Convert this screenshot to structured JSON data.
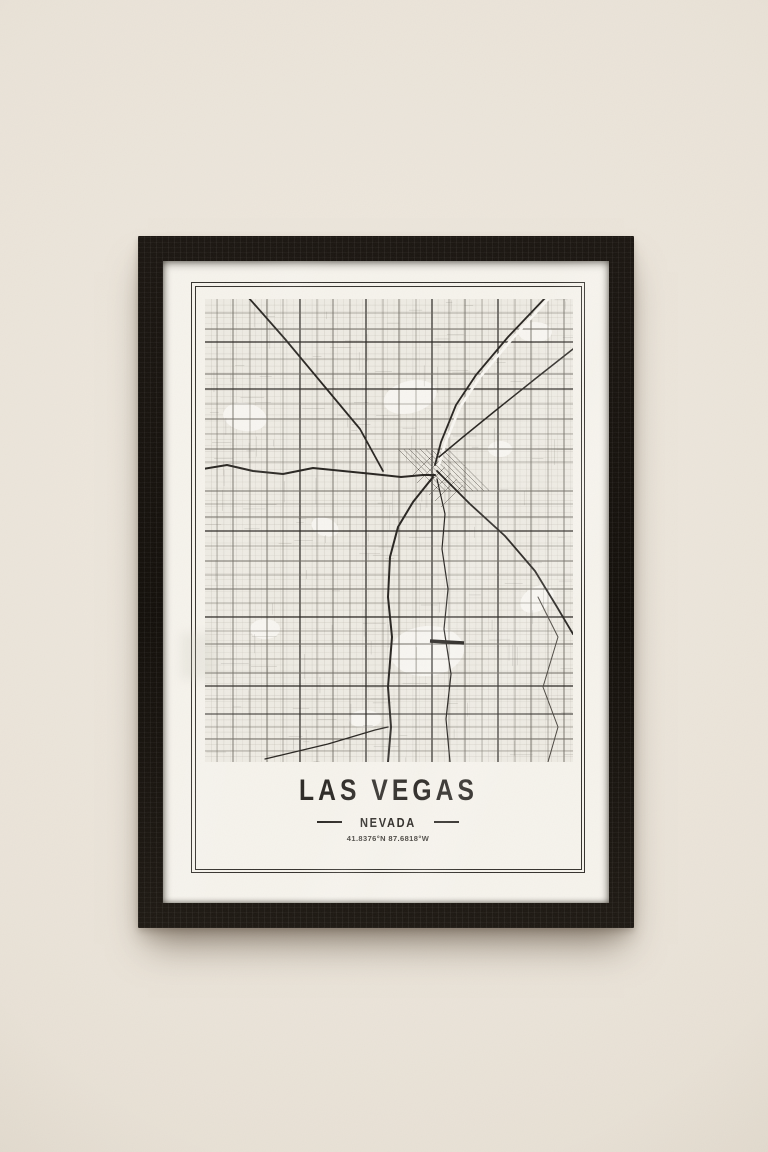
{
  "poster": {
    "title": "LAS VEGAS",
    "subtitle": "NEVADA",
    "coordinates": "41.8376°N 87.6818°W"
  },
  "palette": {
    "wall": "#eae3d8",
    "frame": "#17130e",
    "mat": "#f6f3ec",
    "paper": "#f0ede5",
    "ink": "#2b2824"
  },
  "map": {
    "width": 368,
    "height": 463,
    "bg": "#f0ede5",
    "road_dark": "#26231f",
    "road_mid": "#6e6a61",
    "patch_color": "#fbf9f4",
    "fine_grid": {
      "spacing_x": 6.3,
      "spacing_y": 6.1,
      "color": "#b7b3a9",
      "width": 0.35
    },
    "minor_streets": {
      "count": 170,
      "color": "#8f8b82",
      "width": 0.45,
      "opacity": 0.5,
      "seed": 7
    },
    "patches": [
      {
        "cx": 205,
        "cy": 98,
        "rx": 27,
        "ry": 16,
        "rot": -15
      },
      {
        "cx": 40,
        "cy": 118,
        "rx": 22,
        "ry": 14,
        "rot": 10
      },
      {
        "cx": 222,
        "cy": 352,
        "rx": 37,
        "ry": 25,
        "rot": -5
      },
      {
        "cx": 330,
        "cy": 33,
        "rx": 17,
        "ry": 10,
        "rot": 0
      },
      {
        "cx": 120,
        "cy": 228,
        "rx": 14,
        "ry": 9,
        "rot": 20
      },
      {
        "cx": 332,
        "cy": 300,
        "rx": 18,
        "ry": 12,
        "rot": -30
      },
      {
        "cx": 60,
        "cy": 330,
        "rx": 15,
        "ry": 10,
        "rot": 0
      },
      {
        "cx": 295,
        "cy": 150,
        "rx": 12,
        "ry": 8,
        "rot": 0
      },
      {
        "cx": 160,
        "cy": 420,
        "rx": 16,
        "ry": 9,
        "rot": 0
      }
    ],
    "verticals": [
      {
        "x": 12,
        "w": 0.5
      },
      {
        "x": 28,
        "w": 0.9
      },
      {
        "x": 45,
        "w": 0.5
      },
      {
        "x": 62,
        "w": 0.9
      },
      {
        "x": 78,
        "w": 0.5
      },
      {
        "x": 95,
        "w": 1.2
      },
      {
        "x": 112,
        "w": 0.5
      },
      {
        "x": 128,
        "w": 0.9
      },
      {
        "x": 145,
        "w": 0.5
      },
      {
        "x": 161,
        "w": 1.2
      },
      {
        "x": 178,
        "w": 0.5
      },
      {
        "x": 194,
        "w": 0.9
      },
      {
        "x": 211,
        "w": 0.5
      },
      {
        "x": 227,
        "w": 1.2
      },
      {
        "x": 244,
        "w": 0.5
      },
      {
        "x": 260,
        "w": 0.9
      },
      {
        "x": 277,
        "w": 0.5
      },
      {
        "x": 293,
        "w": 1.2
      },
      {
        "x": 310,
        "w": 0.5
      },
      {
        "x": 326,
        "w": 0.9
      },
      {
        "x": 343,
        "w": 0.5
      },
      {
        "x": 359,
        "w": 0.9
      }
    ],
    "horizontals": [
      {
        "y": 14,
        "w": 0.5
      },
      {
        "y": 30,
        "w": 0.9
      },
      {
        "y": 43,
        "w": 1.2
      },
      {
        "y": 60,
        "w": 0.5
      },
      {
        "y": 75,
        "w": 0.9
      },
      {
        "y": 90,
        "w": 1.2
      },
      {
        "y": 105,
        "w": 0.5
      },
      {
        "y": 120,
        "w": 0.9
      },
      {
        "y": 135,
        "w": 0.5
      },
      {
        "y": 150,
        "w": 0.9
      },
      {
        "y": 163,
        "w": 0.5
      },
      {
        "y": 192,
        "w": 0.9
      },
      {
        "y": 205,
        "w": 0.5
      },
      {
        "y": 218,
        "w": 0.9
      },
      {
        "y": 232,
        "w": 1.2
      },
      {
        "y": 247,
        "w": 0.5
      },
      {
        "y": 262,
        "w": 0.9
      },
      {
        "y": 276,
        "w": 0.5
      },
      {
        "y": 290,
        "w": 0.9
      },
      {
        "y": 304,
        "w": 0.5
      },
      {
        "y": 318,
        "w": 1.3
      },
      {
        "y": 332,
        "w": 0.5
      },
      {
        "y": 345,
        "w": 0.9
      },
      {
        "y": 360,
        "w": 0.5
      },
      {
        "y": 374,
        "w": 0.9
      },
      {
        "y": 387,
        "w": 1.3
      },
      {
        "y": 400,
        "w": 0.5
      },
      {
        "y": 415,
        "w": 1.1
      },
      {
        "y": 428,
        "w": 0.5
      },
      {
        "y": 440,
        "w": 0.9
      },
      {
        "y": 452,
        "w": 0.5
      }
    ],
    "highways": [
      {
        "name": "wash-halo",
        "color": "#fbf9f4",
        "w": 2.6,
        "points": [
          [
            345,
            -2
          ],
          [
            307,
            40
          ],
          [
            275,
            78
          ],
          [
            255,
            108
          ],
          [
            240,
            145
          ],
          [
            234,
            166
          ]
        ]
      },
      {
        "name": "rancho-dr",
        "w": 1.8,
        "points": [
          [
            43,
            -2
          ],
          [
            80,
            40
          ],
          [
            120,
            88
          ],
          [
            155,
            130
          ],
          [
            178,
            172
          ]
        ]
      },
      {
        "name": "us95-west",
        "w": 2.0,
        "points": [
          [
            -2,
            170
          ],
          [
            22,
            166
          ],
          [
            48,
            172
          ],
          [
            78,
            175
          ],
          [
            108,
            169
          ],
          [
            138,
            172
          ],
          [
            168,
            175
          ],
          [
            196,
            178
          ],
          [
            218,
            176
          ],
          [
            230,
            176
          ]
        ]
      },
      {
        "name": "i515-north",
        "w": 1.8,
        "points": [
          [
            341,
            -2
          ],
          [
            303,
            38
          ],
          [
            271,
            76
          ],
          [
            251,
            106
          ],
          [
            236,
            143
          ],
          [
            230,
            166
          ]
        ]
      },
      {
        "name": "east-diagonal",
        "w": 1.5,
        "points": [
          [
            368,
            50
          ],
          [
            330,
            80
          ],
          [
            290,
            112
          ],
          [
            258,
            138
          ],
          [
            234,
            158
          ]
        ]
      },
      {
        "name": "boulder-hwy",
        "w": 1.8,
        "points": [
          [
            232,
            172
          ],
          [
            265,
            205
          ],
          [
            300,
            237
          ],
          [
            330,
            272
          ],
          [
            352,
            308
          ],
          [
            368,
            335
          ]
        ]
      },
      {
        "name": "i15-south",
        "w": 2.0,
        "points": [
          [
            228,
            178
          ],
          [
            208,
            203
          ],
          [
            193,
            228
          ],
          [
            185,
            258
          ],
          [
            183,
            298
          ],
          [
            187,
            338
          ],
          [
            183,
            388
          ],
          [
            186,
            428
          ],
          [
            183,
            463
          ]
        ]
      },
      {
        "name": "las-vegas-blvd",
        "w": 1.2,
        "points": [
          [
            232,
            180
          ],
          [
            240,
            215
          ],
          [
            237,
            250
          ],
          [
            243,
            290
          ],
          [
            239,
            330
          ],
          [
            246,
            375
          ],
          [
            241,
            420
          ],
          [
            245,
            463
          ]
        ]
      },
      {
        "name": "east-wash",
        "color": "#4a463f",
        "w": 1.0,
        "points": [
          [
            333,
            298
          ],
          [
            353,
            338
          ],
          [
            338,
            388
          ],
          [
            353,
            428
          ],
          [
            343,
            463
          ]
        ]
      },
      {
        "name": "sw-diagonal",
        "w": 1.3,
        "points": [
          [
            60,
            460
          ],
          [
            123,
            445
          ],
          [
            170,
            431
          ],
          [
            183,
            428
          ]
        ]
      }
    ],
    "hatches": [
      {
        "x": 193,
        "y": 150,
        "count": 10,
        "step_x": 5.5,
        "step_y": 0,
        "dx": 42,
        "dy": 42,
        "color": "#57534c",
        "w": 0.5
      },
      {
        "x": 206,
        "y": 178,
        "count": 6,
        "step_x": 6,
        "step_y": 6,
        "dx": 22,
        "dy": -22,
        "color": "#57534c",
        "w": 0.5
      }
    ],
    "runway": {
      "x1": 225,
      "y1": 342,
      "x2": 259,
      "y2": 344,
      "w": 3.5
    }
  }
}
